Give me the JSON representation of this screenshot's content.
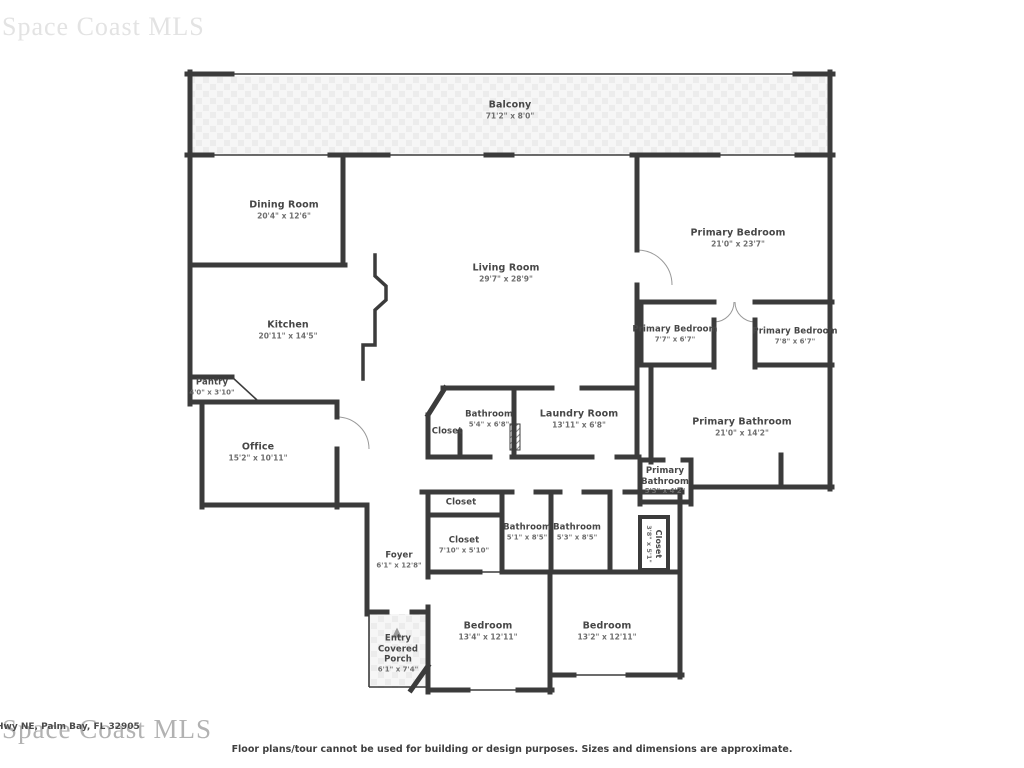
{
  "watermarks": {
    "top_left": "Space Coast MLS",
    "bottom_left": "Space Coast MLS",
    "address": "Hwy NE, Palm Bay, FL 32905"
  },
  "footer": {
    "disclaimer": "Floor plans/tour cannot be used for building or design purposes. Sizes and dimensions are approximate."
  },
  "icons": {
    "entry_arrow": "▲"
  },
  "colors": {
    "wall": "#3b3b3b",
    "label": "#474747",
    "dims": "#6e6e6e",
    "watermark": "#b2b2b2",
    "hatch": "#ececec",
    "door_arc": "#999999"
  },
  "rooms": {
    "balcony": {
      "name": "Balcony",
      "dims": "71'2\" x 8'0\""
    },
    "dining": {
      "name": "Dining Room",
      "dims": "20'4\" x 12'6\""
    },
    "living": {
      "name": "Living Room",
      "dims": "29'7\" x 28'9\""
    },
    "primary_bedroom": {
      "name": "Primary Bedroom",
      "dims": "21'0\" x 23'7\""
    },
    "kitchen": {
      "name": "Kitchen",
      "dims": "20'11\" x 14'5\""
    },
    "pantry": {
      "name": "Pantry",
      "dims": "4'0\" x 3'10\""
    },
    "office": {
      "name": "Office",
      "dims": "15'2\" x 10'11\""
    },
    "closet_hall": {
      "name": "Closet"
    },
    "bathroom_hall": {
      "name": "Bathroom",
      "dims": "5'4\" x 6'8\""
    },
    "laundry": {
      "name": "Laundry Room",
      "dims": "13'11\" x 6'8\""
    },
    "primary_closet_left": {
      "name": "Primary Bedroom",
      "dims": "7'7\" x 6'7\""
    },
    "primary_closet_right": {
      "name": "Primary Bedroom",
      "dims": "7'8\" x 6'7\""
    },
    "primary_bathroom": {
      "name": "Primary Bathroom",
      "dims": "21'0\" x 14'2\""
    },
    "primary_bathroom_small": {
      "name": "Primary Bathroom",
      "dims": "5'3\" x 4'2\""
    },
    "foyer": {
      "name": "Foyer",
      "dims": "6'1\" x 12'8\""
    },
    "closet_top": {
      "name": "Closet"
    },
    "closet_mid": {
      "name": "Closet",
      "dims": "7'10\" x 5'10\""
    },
    "bathroom_1": {
      "name": "Bathroom",
      "dims": "5'1\" x 8'5\""
    },
    "bathroom_2": {
      "name": "Bathroom",
      "dims": "5'3\" x 8'5\""
    },
    "closet_vertical": {
      "name": "Closet",
      "dims": "3'8\" x 5'1\""
    },
    "bedroom_1": {
      "name": "Bedroom",
      "dims": "13'4\" x 12'11\""
    },
    "bedroom_2": {
      "name": "Bedroom",
      "dims": "13'2\" x 12'11\""
    },
    "porch": {
      "name_line1": "Entry",
      "name_line2": "Covered Porch",
      "dims": "6'1\" x 7'4\""
    }
  }
}
